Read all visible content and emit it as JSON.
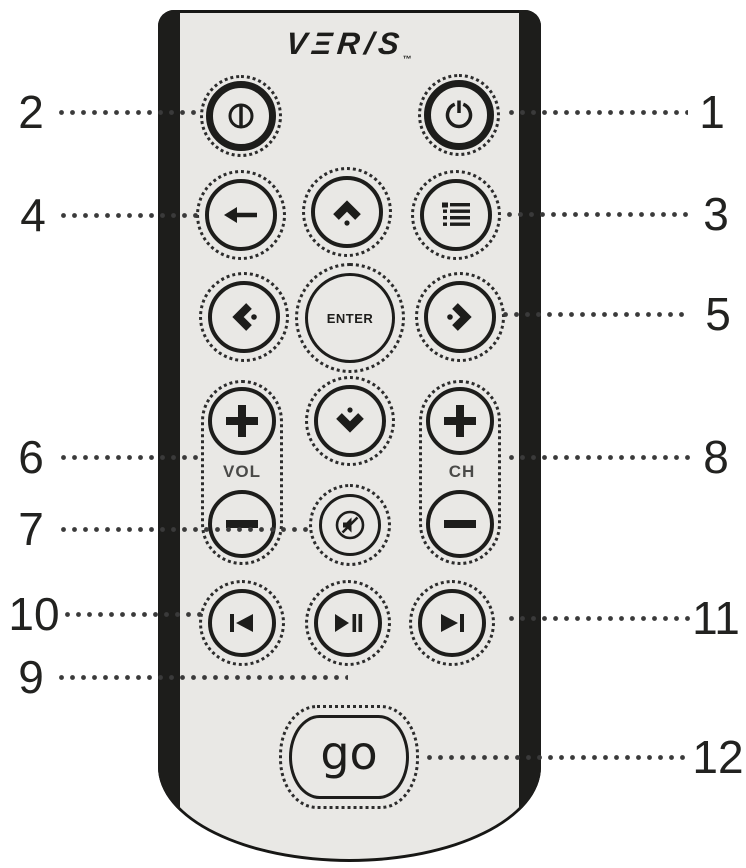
{
  "diagram": {
    "brand": {
      "logo_text": "VΞR/S",
      "trademark": "™"
    },
    "buttons": {
      "enter": "ENTER",
      "volume_group": "VOL",
      "channel_group": "CH",
      "go": "go"
    },
    "callouts": [
      {
        "number": "1",
        "target": "power-button"
      },
      {
        "number": "2",
        "target": "io-power-button"
      },
      {
        "number": "3",
        "target": "menu-button"
      },
      {
        "number": "4",
        "target": "back-button"
      },
      {
        "number": "5",
        "target": "right-arrow-button"
      },
      {
        "number": "6",
        "target": "volume-buttons"
      },
      {
        "number": "7",
        "target": "mute-button"
      },
      {
        "number": "8",
        "target": "channel-buttons"
      },
      {
        "number": "9",
        "target": "play-pause-button"
      },
      {
        "number": "10",
        "target": "previous-button"
      },
      {
        "number": "11",
        "target": "next-button"
      },
      {
        "number": "12",
        "target": "go-button"
      }
    ],
    "icons": {
      "io-power-icon": "⏼",
      "power-icon": "⏻",
      "back-arrow-icon": "←",
      "chevron-up-icon": "⌃",
      "chevron-down-icon": "⌄",
      "chevron-left-icon": "‹",
      "chevron-right-icon": "›",
      "menu-list-icon": "☰",
      "mute-icon": "🔇",
      "previous-icon": "⏮",
      "play-pause-icon": "⏯",
      "next-icon": "⏭",
      "plus-icon": "+",
      "minus-icon": "−"
    },
    "colors": {
      "body": "#e9e8e5",
      "ink": "#1d1d1b",
      "background": "#ffffff",
      "label_gray": "#4a4a48"
    }
  }
}
